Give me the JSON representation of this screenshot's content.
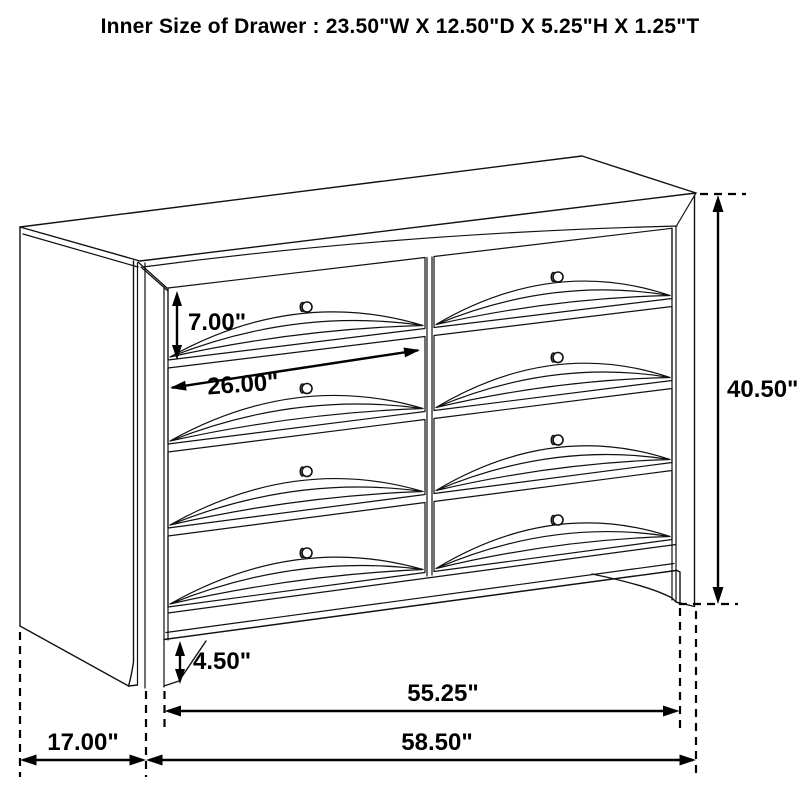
{
  "title": "Inner Size of Drawer : 23.50\"W X 12.50\"D X 5.25\"H X 1.25\"T",
  "dimensions": {
    "drawer_front_height": "7.00\"",
    "drawer_front_width": "26.00\"",
    "overall_height": "40.50\"",
    "foot_height": "4.50\"",
    "case_front_width": "55.25\"",
    "overall_width": "58.50\"",
    "side_depth": "17.00\""
  },
  "drawing": {
    "kind": "furniture dimension diagram",
    "drawer_rows": 4,
    "drawer_columns": 2,
    "knob_count": 8,
    "line_color": "#111111",
    "dimension_color": "#000000",
    "background_color": "#ffffff"
  }
}
